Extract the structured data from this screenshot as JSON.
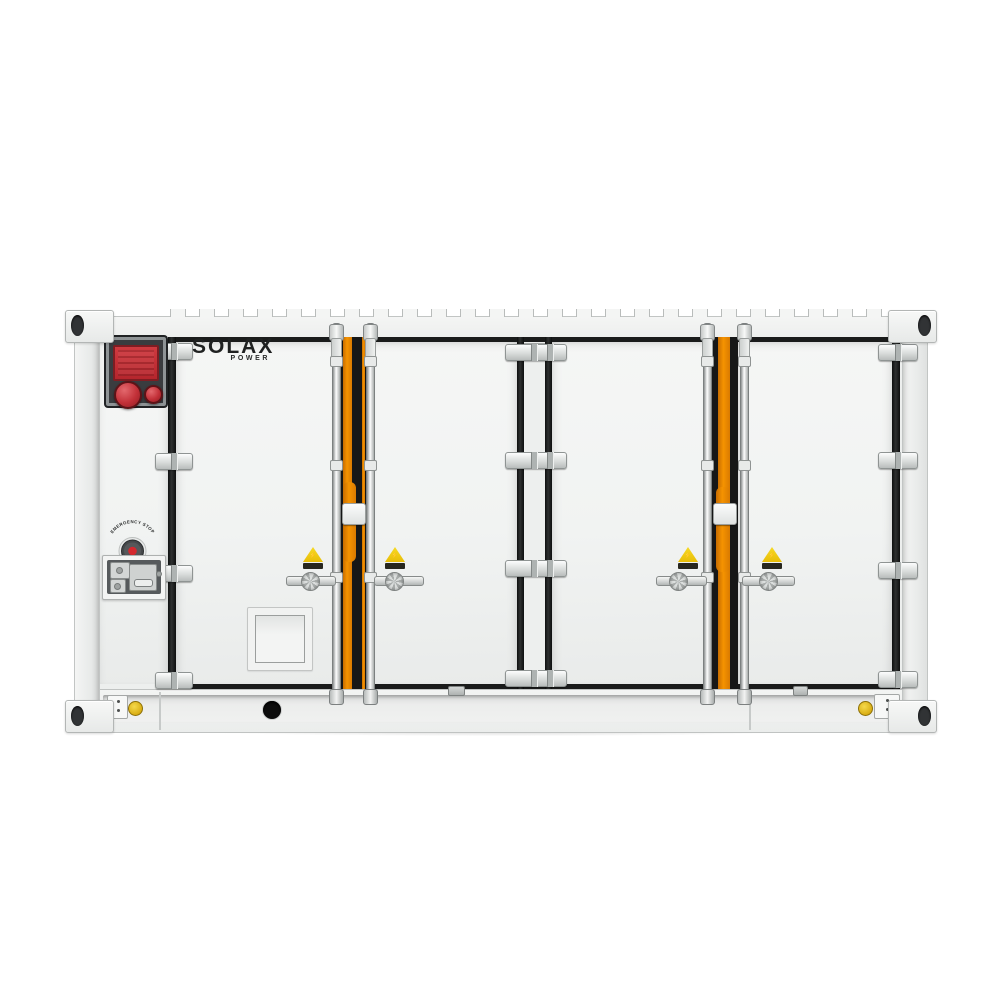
{
  "brand": {
    "name": "SOLAX",
    "sub": "POWER"
  },
  "labels": {
    "emergency_stop": "EMERGENCY STOP",
    "danger": "DANGER"
  },
  "icons": {
    "lightning": "⚡"
  },
  "colors": {
    "body_white": "#f0f1f0",
    "frame_black": "#161717",
    "accent_orange": "#f08a00",
    "alarm_red": "#c4343b",
    "warning_yellow": "#f0ce17",
    "metal_gray": "#d7dada",
    "background": "#ffffff"
  },
  "structure": {
    "door_count": 4,
    "hinge_rows": 4,
    "lock_rod_count": 4,
    "warning_label_count": 4
  }
}
